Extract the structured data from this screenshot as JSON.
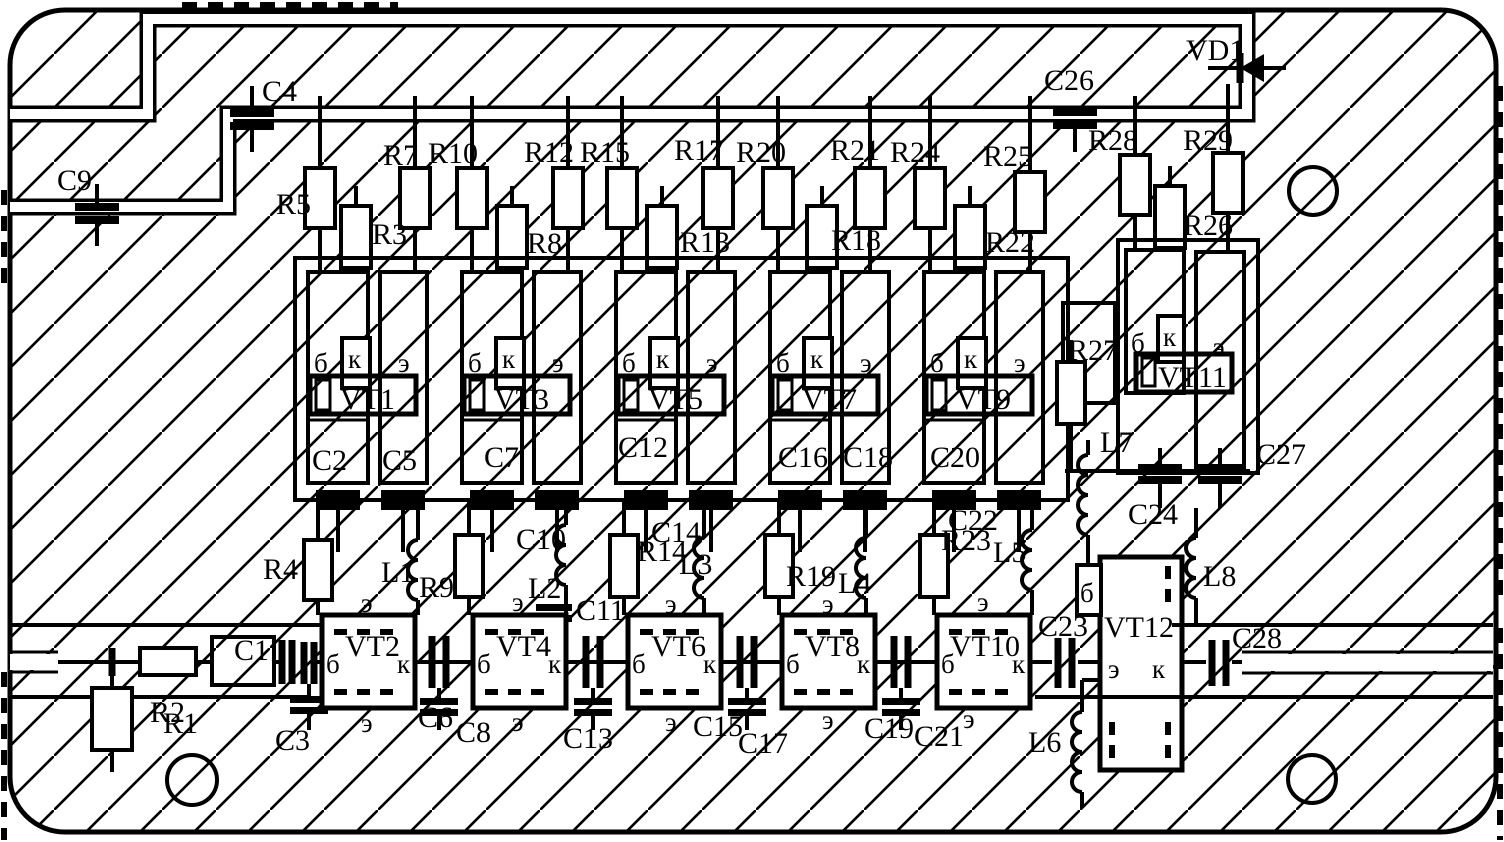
{
  "terminals": {
    "base": "б",
    "collector": "к",
    "emitter": "э"
  },
  "labels": {
    "VD1": "VD1",
    "R1": "R1",
    "R2": "R2",
    "R3": "R3",
    "R4": "R4",
    "R5": "R5",
    "R7": "R7",
    "R8": "R8",
    "R9": "R9",
    "R10": "R10",
    "R12": "R12",
    "R13": "R13",
    "R14": "R14",
    "R15": "R15",
    "R17": "R17",
    "R18": "R18",
    "R19": "R19",
    "R20": "R20",
    "R21": "R21",
    "R22": "R22",
    "R23": "R23",
    "R24": "R24",
    "R25": "R25",
    "R26": "R26",
    "R27": "R27",
    "R28": "R28",
    "R29": "R29",
    "C1": "C1",
    "C2": "C2",
    "C3": "C3",
    "C4": "C4",
    "C5": "C5",
    "C6": "C6",
    "C7": "C7",
    "C8": "C8",
    "C9": "C9",
    "C10": "C10",
    "C11": "C11",
    "C12": "C12",
    "C13": "C13",
    "C14": "C14",
    "C15": "C15",
    "C16": "C16",
    "C17": "C17",
    "C18": "C18",
    "C19": "C19",
    "C20": "C20",
    "C21": "C21",
    "C22": "C22",
    "C23": "C23",
    "C24": "C24",
    "C26": "C26",
    "C27": "C27",
    "C28": "C28",
    "L1": "L1",
    "L2": "L2",
    "L3": "L3",
    "L4": "L4",
    "L5": "L5",
    "L6": "L6",
    "L7": "L7",
    "L8": "L8",
    "VT1": "VT1",
    "VT2": "VT2",
    "VT3": "VT3",
    "VT4": "VT4",
    "VT5": "VT5",
    "VT6": "VT6",
    "VT7": "VT7",
    "VT8": "VT8",
    "VT9": "VT9",
    "VT10": "VT10",
    "VT11": "VT11",
    "VT12": "VT12"
  }
}
